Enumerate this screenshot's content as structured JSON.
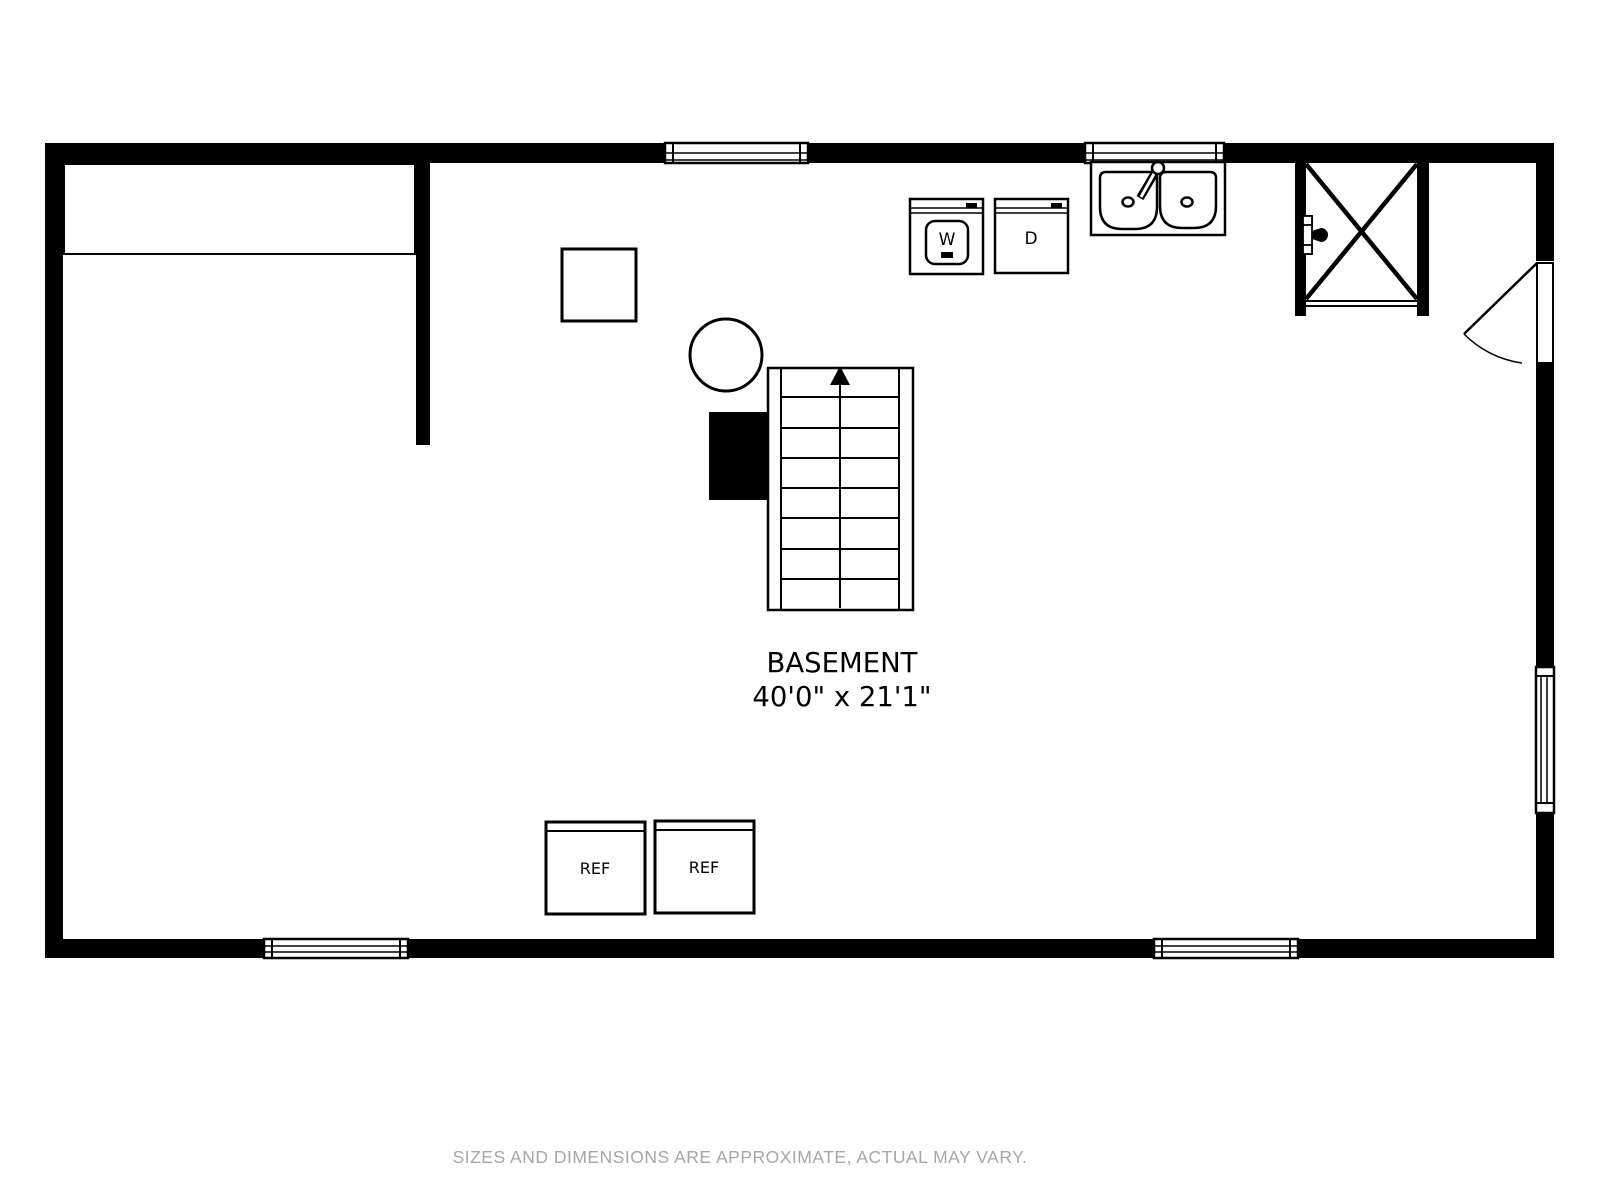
{
  "floor_plan": {
    "room": {
      "name": "BASEMENT",
      "dimensions": "40'0\" x 21'1\""
    },
    "appliances": {
      "washer_label": "W",
      "dryer_label": "D",
      "fridge1_label": "REF",
      "fridge2_label": "REF"
    },
    "footer": {
      "disclaimer": "SIZES AND DIMENSIONS ARE APPROXIMATE, ACTUAL MAY VARY."
    },
    "colors": {
      "wall": "#000000",
      "line": "#000000",
      "background": "#ffffff",
      "footer_text": "#a6a6a6"
    }
  }
}
